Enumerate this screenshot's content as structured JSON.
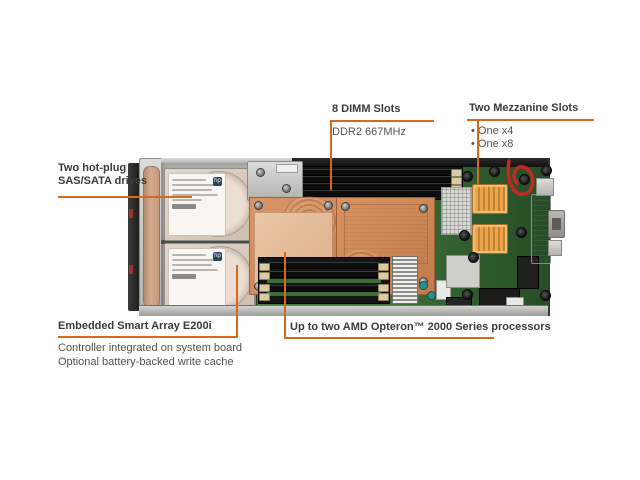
{
  "figure": {
    "description": "Annotated top view of an HP blade server board",
    "accent_color": "#d7691c",
    "background": "#ffffff"
  },
  "callouts": {
    "drives": {
      "line1": "Two hot-plug",
      "line2": "SAS/SATA drives"
    },
    "dimm": {
      "title": "8 DIMM Slots",
      "subtitle": "DDR2 667MHz"
    },
    "mezzanine": {
      "title": "Two Mezzanine Slots",
      "items": [
        "• One x4",
        "• One x8"
      ]
    },
    "smart_array": {
      "title": "Embedded Smart Array E200i",
      "details": [
        "Controller integrated on system board",
        "Optional battery-backed write cache"
      ]
    },
    "processors": {
      "title": "Up to two AMD Opteron™ 2000 Series processors"
    }
  },
  "hardware": {
    "drive_logo": "hp"
  }
}
